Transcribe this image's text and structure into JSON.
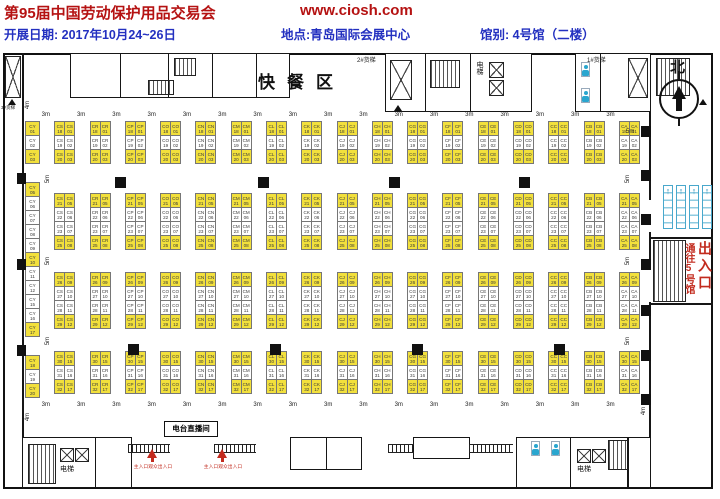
{
  "header": {
    "title": "第95届中国劳动保护用品交易会",
    "website": "www.ciosh.com",
    "date": "开展日期: 2017年10月24~26日",
    "location": "地点:青岛国际会展中心",
    "hall": "馆别: 4号馆（二楼）"
  },
  "plan": {
    "labels": {
      "fast_food": "快餐区",
      "north": "北",
      "freight_1": "1#货梯",
      "freight_2": "2#货梯",
      "freight_3": "3#货梯",
      "elevator": "电梯",
      "radio_room": "电台直播间",
      "main_entrance": "主入口观众出入口",
      "to_hall5": "通往5号馆",
      "exit": "出入口",
      "dim_3m": "3m",
      "dim_4m": "4m",
      "dim_5m": "5m"
    },
    "colors": {
      "booth_sold": "#f2e03c",
      "booth_free": "#ffffff",
      "accent_red": "#c22b1e",
      "header_red": "#b51212",
      "header_blue": "#2330c0",
      "icon_cyan": "#2aa6cf"
    },
    "booths": {
      "cy_column": {
        "prefix": "CY",
        "groups": [
          {
            "gap": 19,
            "cells": [
              {
                "n": "01",
                "sold": true
              },
              {
                "n": "02",
                "sold": false
              },
              {
                "n": "03",
                "sold": true
              }
            ]
          },
          {
            "gap": 19,
            "cells": [
              {
                "n": "05",
                "sold": true
              },
              {
                "n": "06",
                "sold": false
              },
              {
                "n": "07",
                "sold": false
              },
              {
                "n": "08",
                "sold": false
              },
              {
                "n": "09",
                "sold": false
              },
              {
                "n": "10",
                "sold": true
              },
              {
                "n": "11",
                "sold": false
              },
              {
                "n": "12",
                "sold": false
              },
              {
                "n": "15",
                "sold": false
              },
              {
                "n": "16",
                "sold": false
              },
              {
                "n": "17",
                "sold": true
              }
            ]
          },
          {
            "gap": 0,
            "cells": [
              {
                "n": "18",
                "sold": true
              },
              {
                "n": "19",
                "sold": false
              },
              {
                "n": "20",
                "sold": true
              }
            ]
          }
        ]
      },
      "pair_prefixes": [
        "CS",
        "CR",
        "CP",
        "CO",
        "CN",
        "CM",
        "CL",
        "CK",
        "CJ",
        "CH",
        "CG",
        "CF",
        "CE",
        "CD",
        "CC",
        "CB",
        "CA"
      ],
      "blocks": [
        {
          "aisle": 30,
          "rows": [
            {
              "l": "18",
              "r": "01",
              "sold": true
            },
            {
              "l": "19",
              "r": "02",
              "sold": false
            },
            {
              "l": "20",
              "r": "03",
              "sold": true
            }
          ]
        },
        {
          "aisle": 23,
          "rows": [
            {
              "l": "21",
              "r": "05",
              "sold": true
            },
            {
              "l": "22",
              "r": "06",
              "sold": false
            },
            {
              "l": "23",
              "r": "07",
              "sold": false
            },
            {
              "l": "25",
              "r": "08",
              "sold": true
            }
          ]
        },
        {
          "aisle": 23,
          "rows": [
            {
              "l": "26",
              "r": "09",
              "sold": true
            },
            {
              "l": "27",
              "r": "10",
              "sold": false
            },
            {
              "l": "28",
              "r": "11",
              "sold": false
            },
            {
              "l": "29",
              "r": "12",
              "sold": true
            }
          ]
        },
        {
          "aisle": 0,
          "rows": [
            {
              "l": "30",
              "r": "15",
              "sold": true
            },
            {
              "l": "31",
              "r": "16",
              "sold": false
            },
            {
              "l": "32",
              "r": "17",
              "sold": true
            }
          ]
        }
      ]
    }
  }
}
